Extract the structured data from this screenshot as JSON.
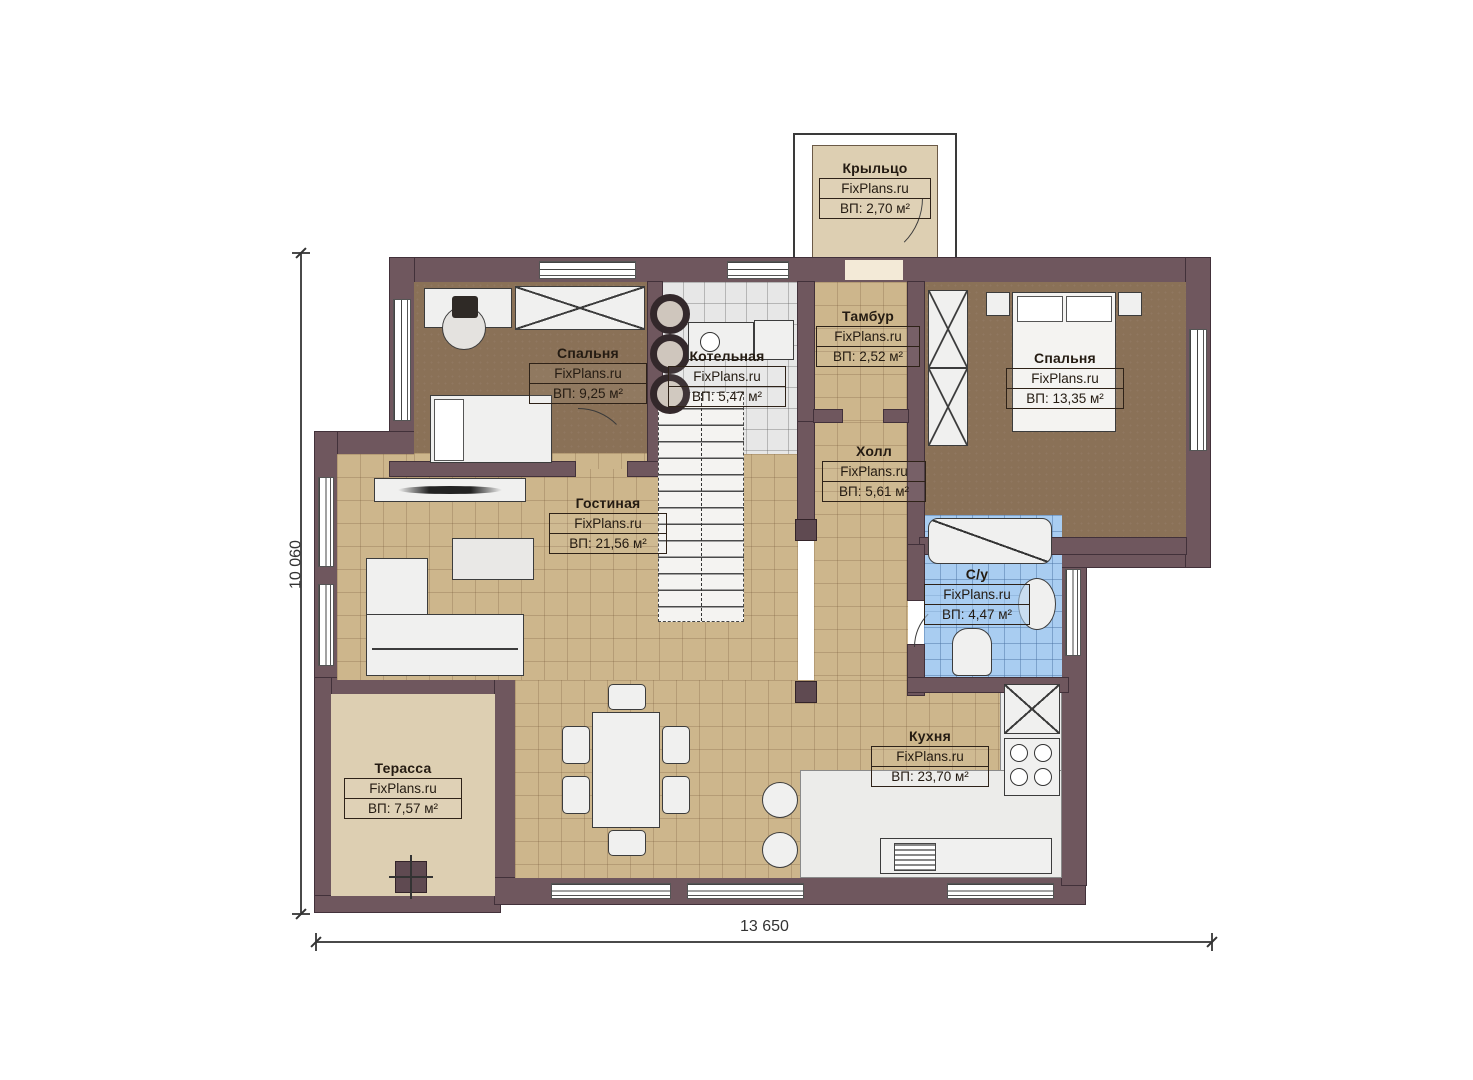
{
  "plan": {
    "site": "FixPlans.ru",
    "dimensions": {
      "width_label": "13 650",
      "height_label": "10 060"
    },
    "rooms": [
      {
        "id": "porch",
        "name": "Крыльцо",
        "area": "ВП: 2,70 м²"
      },
      {
        "id": "bedroom1",
        "name": "Спальня",
        "area": "ВП: 9,25 м²"
      },
      {
        "id": "boiler",
        "name": "Котельная",
        "area": "ВП: 5,47 м²"
      },
      {
        "id": "tambour",
        "name": "Тамбур",
        "area": "ВП: 2,52 м²"
      },
      {
        "id": "bedroom2",
        "name": "Спальня",
        "area": "ВП: 13,35 м²"
      },
      {
        "id": "hall",
        "name": "Холл",
        "area": "ВП: 5,61 м²"
      },
      {
        "id": "living",
        "name": "Гостиная",
        "area": "ВП: 21,56 м²"
      },
      {
        "id": "bathroom",
        "name": "С/у",
        "area": "ВП: 4,47 м²"
      },
      {
        "id": "kitchen",
        "name": "Кухня",
        "area": "ВП: 23,70 м²"
      },
      {
        "id": "terrace",
        "name": "Терасса",
        "area": "ВП: 7,57 м²"
      }
    ],
    "colors": {
      "wall": "#6f575e",
      "floor_tile_tan": "#cdb68c",
      "floor_bedroom_brown": "#8a7157",
      "floor_boiler_gray": "#e7e7e7",
      "floor_bath_blue": "#a9cdf1",
      "terrace": "#ddcfb2"
    }
  }
}
